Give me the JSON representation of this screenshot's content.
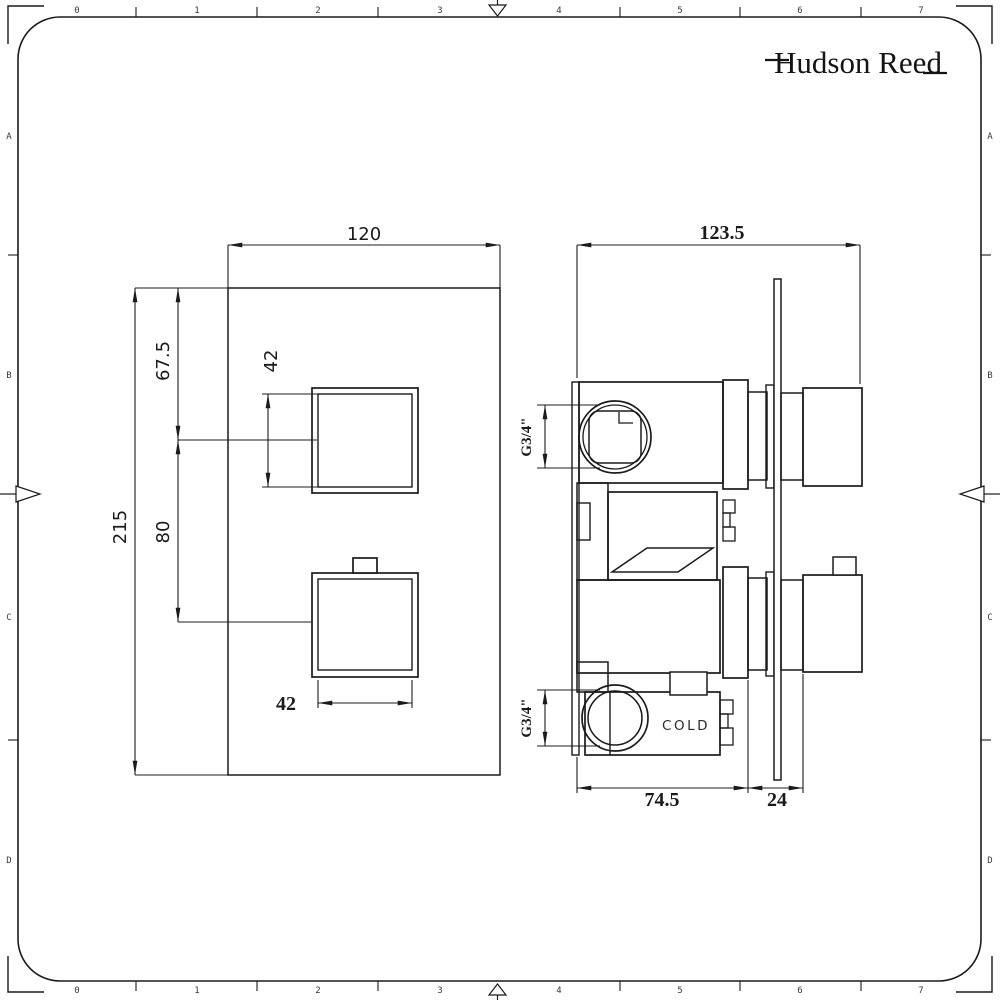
{
  "brand": {
    "logo_text": "Hudson Reed"
  },
  "sheet": {
    "ruler_numbers": [
      "0",
      "1",
      "2",
      "3",
      "4",
      "5",
      "6",
      "7"
    ],
    "ruler_letters": [
      "A",
      "B",
      "C",
      "D"
    ]
  },
  "front_view": {
    "plate_width": "120",
    "plate_height": "215",
    "top_to_handle_center": "67.5",
    "handle_center_spacing": "80",
    "handle_width_top": "42",
    "handle_width_bottom": "42"
  },
  "side_view": {
    "total_depth": "123.5",
    "body_depth": "74.5",
    "plate_to_handle": "24",
    "top_inlet_thread": "G3/4\"",
    "bottom_inlet_thread": "G3/4\"",
    "cold_label": "COLD"
  },
  "colors": {
    "line": "#1b1b1b",
    "background": "#ffffff"
  }
}
